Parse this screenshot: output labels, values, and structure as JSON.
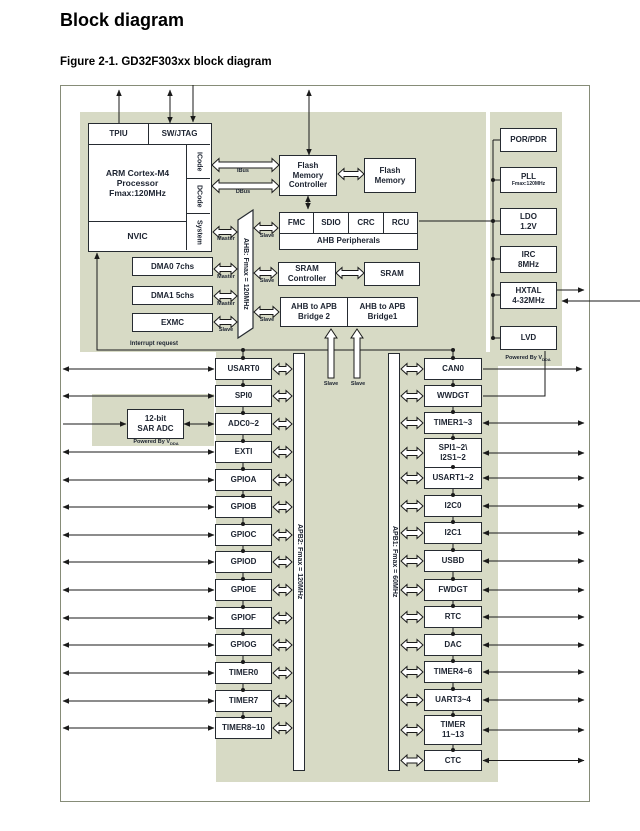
{
  "page": {
    "title": "Block diagram",
    "figure_caption": "Figure 2-1. GD32F303xx block diagram"
  },
  "colors": {
    "region_green": "#d7dac5",
    "box_border": "#262b31",
    "wire": "#1a1a1a"
  },
  "cpu": {
    "tpiu": "TPIU",
    "swjtag": "SW/JTAG",
    "core_l1": "ARM Cortex-M4",
    "core_l2": "Processor",
    "core_l3": "Fmax:120MHz",
    "nvic": "NVIC",
    "icode": "ICode",
    "dcode": "DCode",
    "system": "System"
  },
  "labels": {
    "ibus": "IBus",
    "dbus": "DBus",
    "master": "Master",
    "slave": "Slave",
    "interrupt": "Interrupt request",
    "powered_prefix": "Powered By V",
    "powered_sub": "DDA"
  },
  "buses": {
    "ahb": "AHB: Fmax = 120MHz",
    "apb2": "APB2: Fmax = 120MHz",
    "apb1": "APB1: Fmax = 60MHz"
  },
  "blocks": {
    "flash_ctrl_l1": "Flash",
    "flash_ctrl_l2": "Memory",
    "flash_ctrl_l3": "Controller",
    "flash_mem_l1": "Flash",
    "flash_mem_l2": "Memory",
    "ahb_cells": [
      "FMC",
      "SDIO",
      "CRC",
      "RCU"
    ],
    "ahb_band": "AHB Peripherals",
    "sram_ctrl_l1": "SRAM",
    "sram_ctrl_l2": "Controller",
    "sram": "SRAM",
    "bridge2_l1": "AHB to APB",
    "bridge2_l2": "Bridge 2",
    "bridge1_l1": "AHB to APB",
    "bridge1_l2": "Bridge1",
    "dma0": "DMA0 7chs",
    "dma1": "DMA1 5chs",
    "exmc": "EXMC",
    "sar_l1": "12-bit",
    "sar_l2": "SAR ADC"
  },
  "power": {
    "items": [
      {
        "l1": "POR/PDR"
      },
      {
        "l1": "PLL",
        "l2": "Fmax:120MHz"
      },
      {
        "l1": "LDO",
        "l2": "1.2V"
      },
      {
        "l1": "IRC",
        "l2": "8MHz"
      },
      {
        "l1": "HXTAL",
        "l2": "4-32MHz"
      },
      {
        "l1": "LVD"
      }
    ]
  },
  "left_column": {
    "items": [
      "USART0",
      "SPI0",
      "ADC0~2",
      "EXTI",
      "GPIOA",
      "GPIOB",
      "GPIOC",
      "GPIOD",
      "GPIOE",
      "GPIOF",
      "GPIOG",
      "TIMER0",
      "TIMER7",
      "TIMER8~10"
    ]
  },
  "right_column": {
    "items": [
      {
        "l1": "CAN0"
      },
      {
        "l1": "WWDGT"
      },
      {
        "l1": "TIMER1~3"
      },
      {
        "l1": "SPI1~2\\",
        "l2": "I2S1~2"
      },
      {
        "l1": "USART1~2"
      },
      {
        "l1": "I2C0"
      },
      {
        "l1": "I2C1"
      },
      {
        "l1": "USBD"
      },
      {
        "l1": "FWDGT"
      },
      {
        "l1": "RTC"
      },
      {
        "l1": "DAC"
      },
      {
        "l1": "TIMER4~6"
      },
      {
        "l1": "UART3~4"
      },
      {
        "l1": "TIMER",
        "l2": "11~13"
      },
      {
        "l1": "CTC"
      }
    ]
  }
}
